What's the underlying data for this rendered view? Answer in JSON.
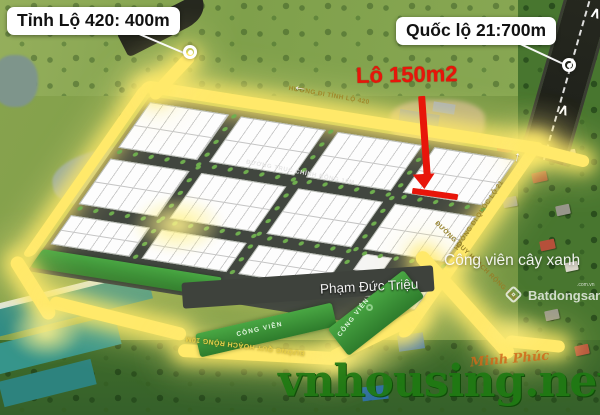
{
  "annotations": {
    "tinh_lo_label": "Tỉnh Lộ 420: 400m",
    "quoc_lo_label": "Quốc lộ 21:700m",
    "lot_label": "Lô 150m2"
  },
  "plan": {
    "road_top": "HƯỚNG ĐI TỈNH LỘ 420",
    "road_main": "ĐƯỜNG TRỤC CHÍNH RỘNG 10M",
    "road_right": "HƯỚNG ĐI QUỐC LỘ 21",
    "road_bottom_10": "ĐƯỜNG QUY HOẠCH RỘNG 10M",
    "road_bottom_20": "ĐƯỜNG QUY HOẠCH RỘNG 20M",
    "street_name": "Phạm Đức Triệu",
    "park_label": "CÔNG VIÊN",
    "park_watermark": "Công viên cây xanh"
  },
  "watermarks": {
    "site": "vnhousing.net",
    "brand_name": "Batdongsan",
    "brand_domain": ".com.vn",
    "signature": "Minh Phúc"
  },
  "icons": {
    "arrow_left": "←",
    "arrow_up": "↑",
    "chevron_up": "∧"
  },
  "colors": {
    "glow_road": "#ffe96a",
    "annotation_red": "#e8150a",
    "park_green": "#3c9c38",
    "site_watermark_green": "#1e7a12",
    "label_box_bg": "#ffffff"
  }
}
